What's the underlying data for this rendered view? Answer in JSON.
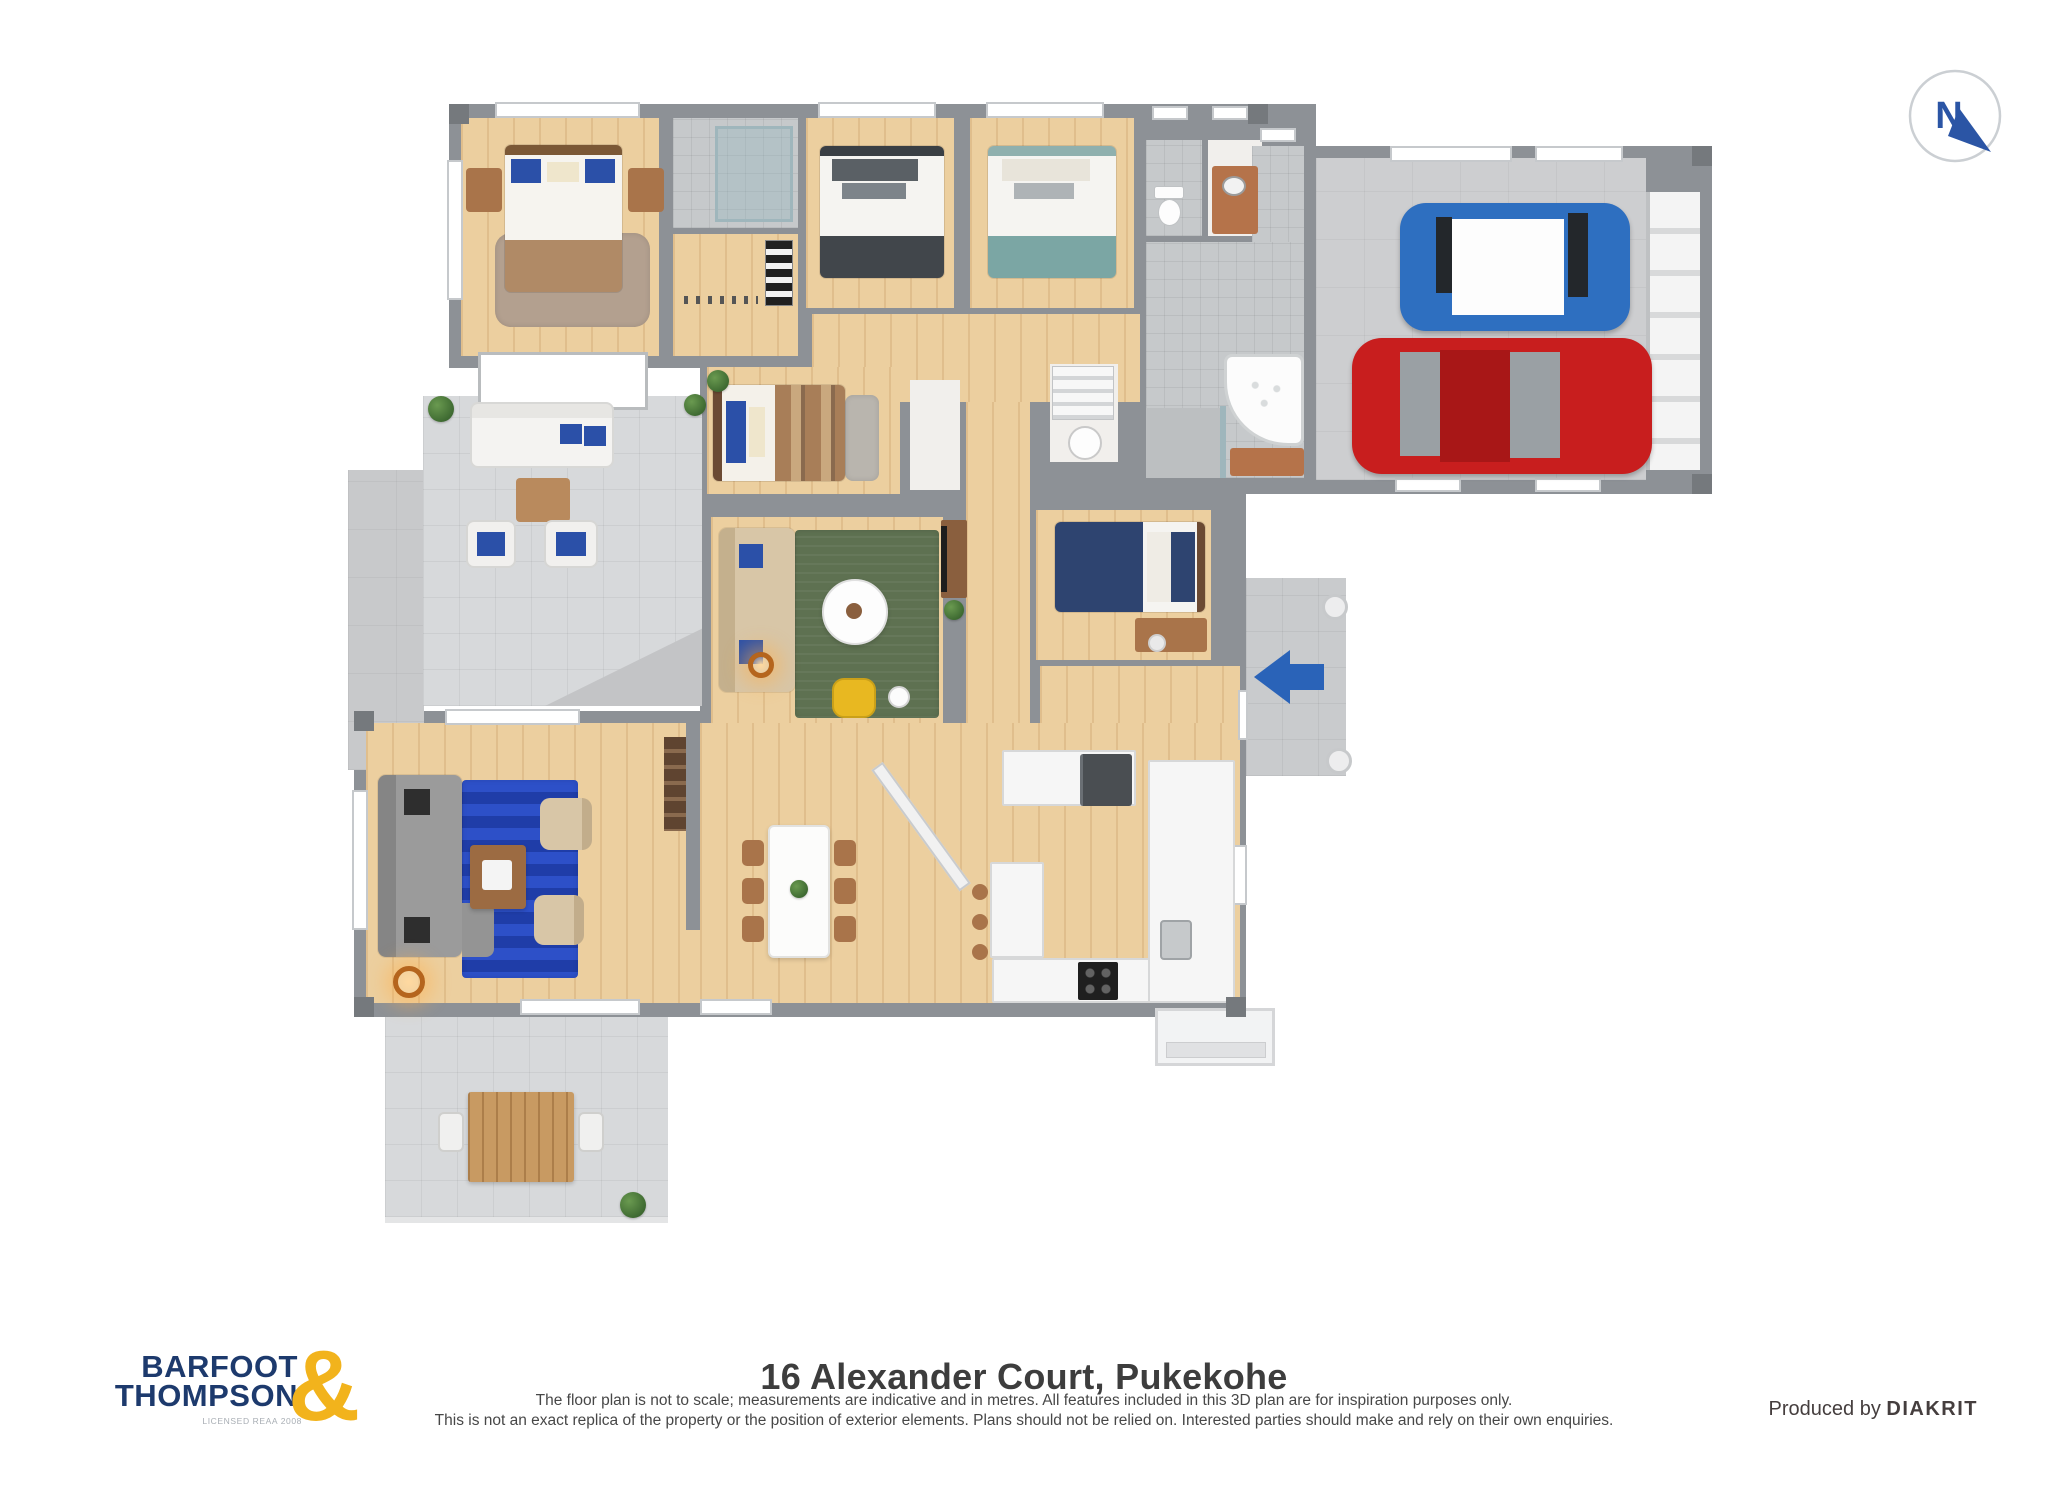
{
  "compass": {
    "letter": "N"
  },
  "logo": {
    "line1": "BARFOOT",
    "line2": "THOMPSON",
    "ampersand": "&",
    "license": "LICENSED REAA 2008"
  },
  "footer": {
    "title": "16 Alexander Court, Pukekohe",
    "disclaimer_line1": "The floor plan is not to scale; measurements are indicative and in metres. All features included in this 3D plan are for inspiration purposes only.",
    "disclaimer_line2": "This is not an exact replica of the property or the position of exterior elements. Plans should not be relied on. Interested parties should make and rely on their own enquiries.",
    "produced_by": "Produced by",
    "producer": "DIAKRIT"
  },
  "colors": {
    "logo-navy": "#1d3a6d",
    "logo-gold": "#f2b31c",
    "compass-blue": "#2b55a5",
    "arrow-blue": "#2a63b8",
    "wall": "#8d9196",
    "wall-dark": "#75797d",
    "wood": "#eccf9f",
    "tile": "#d7d9db",
    "garage-floor": "#cdced0",
    "rug-green": "#5e7151",
    "rug-blue": "#2d50c8",
    "rug-blue-dark": "#1f3da8",
    "rug-brown": "#b3a08f",
    "rug-gray": "#b9b5ae",
    "sofa-gray": "#9b9b9b",
    "sofa-beige": "#d8c6a7",
    "bed-navy": "#2e4470",
    "bed-teal": "#7ba6a4",
    "bed-charcoal": "#41464b",
    "bed-brown": "#b08a66",
    "pillow-blue": "#2b50a8",
    "wood-furniture": "#a9744a",
    "copper": "#b5734a",
    "car-red": "#c81e1e",
    "car-blue": "#2e6fc0",
    "text-dark": "#3d3d3d"
  }
}
